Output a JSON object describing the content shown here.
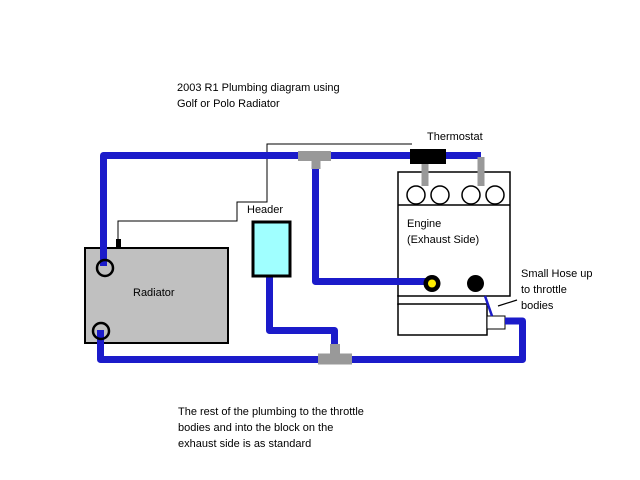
{
  "title": {
    "line1": "2003 R1 Plumbing diagram using",
    "line2": "Golf or Polo Radiator"
  },
  "labels": {
    "thermostat": "Thermostat",
    "header": "Header",
    "engine_line1": "Engine",
    "engine_line2": "(Exhaust Side)",
    "radiator": "Radiator",
    "small_hose_line1": "Small Hose up",
    "small_hose_line2": "to throttle",
    "small_hose_line3": "bodies"
  },
  "note": {
    "line1": "The rest of the plumbing to the throttle",
    "line2": "bodies and into the block on the",
    "line3": "exhaust side is as standard"
  },
  "colors": {
    "hose_blue": "#1b1bca",
    "connector_gray": "#999999",
    "radiator_gray": "#c0c0c0",
    "header_cyan": "#a0ffff",
    "thermostat_black": "#000000",
    "port_yellow": "#ffee00",
    "background": "#ffffff"
  }
}
